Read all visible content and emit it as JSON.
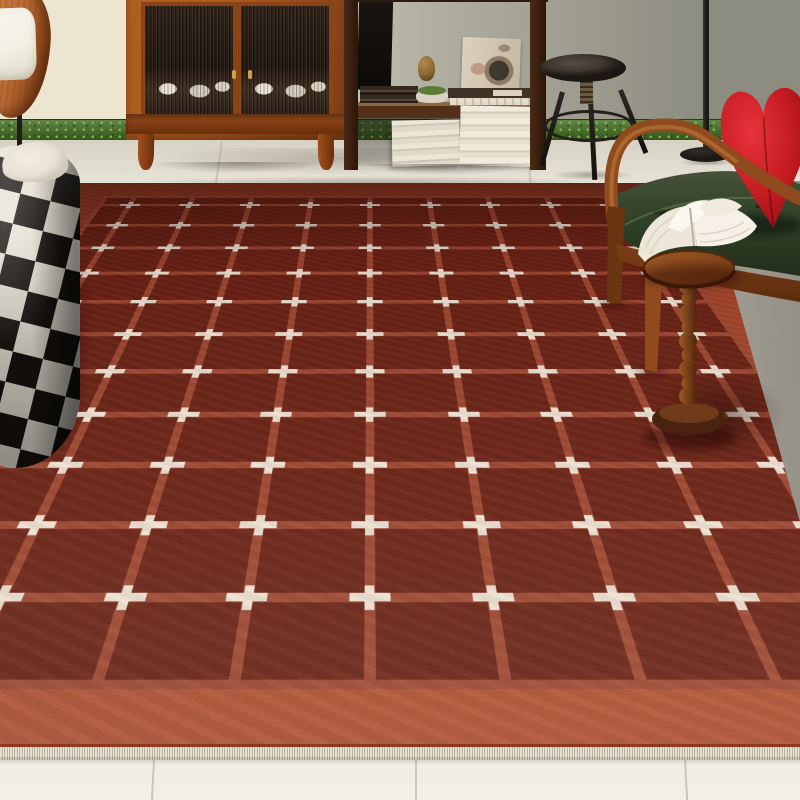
{
  "scene": {
    "description": "product photo of a terracotta red grid rug with white cross motifs in a mid-century living room",
    "objects": [
      {
        "name": "wood-sculpture-lamp"
      },
      {
        "name": "display-cabinet"
      },
      {
        "name": "open-shelf-unit"
      },
      {
        "name": "adjustable-stool"
      },
      {
        "name": "floor-lamp"
      },
      {
        "name": "checkered-pouf"
      },
      {
        "name": "wood-armchair"
      },
      {
        "name": "heart-pillow"
      },
      {
        "name": "beaded-side-table"
      },
      {
        "name": "open-book"
      },
      {
        "name": "grid-cross-rug"
      }
    ]
  },
  "palette": {
    "wall_left": "#ece5cf",
    "wall_mid": "#b2b1a3",
    "wall_right": "#8d8c80",
    "baseboard": "#3f6b1e",
    "baseboard_dot1": "#85b24a",
    "baseboard_dot2": "#2e5214",
    "tile_top": "#d6d2c4",
    "tile_mid": "#e9e6db",
    "tile_bottom": "#f1efe7",
    "tile_joint": "#c0bcae",
    "rug_band": "#a04129",
    "rug_band_light": "#b15133",
    "rug_field": "#682114",
    "rug_line": "#9c4630",
    "rug_cross": "#ece0d2",
    "rug_edge": "#8d3a22",
    "fringe_light": "#efe9dc",
    "fringe_dark": "#b8b2a2",
    "wood_cabinet": "#a8571f",
    "wood_cabinet_dark": "#7d3c14",
    "cabinet_interior": "#241711",
    "dish_white": "#e8e2d4",
    "knob_brass": "#c9a24a",
    "book_brown": "#3f3226",
    "book_stack_light": "#ece6d6",
    "book_stack_mid": "#cfc8b5",
    "box_cream": "#d8cbb6",
    "moss_green": "#5d7c36",
    "vase_bronze": "#8a6a34",
    "stool_seat": "#3f3831",
    "stool_dark": "#15120e",
    "lamp_black": "#1b1815",
    "pouf_black": "#17130f",
    "pouf_white": "#e7e2d5",
    "sculpt_wood": "#b96b35",
    "sculpt_wood_dark": "#7d3c14",
    "sculpt_white": "#f3f0e4",
    "pole_black": "#211d19",
    "chair_wood": "#8f4b1d",
    "chair_wood_light": "#b9743a",
    "chair_wood_dark": "#6b3512",
    "cushion_green": "#2f4227",
    "cushion_dark": "#232d1a",
    "cushion_light": "#46513a",
    "heart_red": "#c01a20",
    "heart_light": "#e8333a",
    "heart_dark": "#7e0d12",
    "table_wood": "#8a4a1e",
    "table_dark": "#56290e",
    "page_white": "#f5f1e6",
    "page_shadow": "#d6d0bf"
  },
  "rug": {
    "grid_rows": 11,
    "grid_cols": 9,
    "col_start": 25.5,
    "col_step": 56.6,
    "row_start": 16,
    "row_step": 42,
    "cross_width": 19,
    "cross_height": 13,
    "cross_thickness": 4.5
  },
  "floor": {
    "joints_top": [
      {
        "x": 218,
        "rot": 8
      },
      {
        "x": 528,
        "rot": -4
      },
      {
        "x": 760,
        "rot": -7
      }
    ],
    "joints_bottom": [
      {
        "x": 152,
        "rot": 3
      },
      {
        "x": 415,
        "rot": 0
      },
      {
        "x": 685,
        "rot": -3
      }
    ]
  }
}
